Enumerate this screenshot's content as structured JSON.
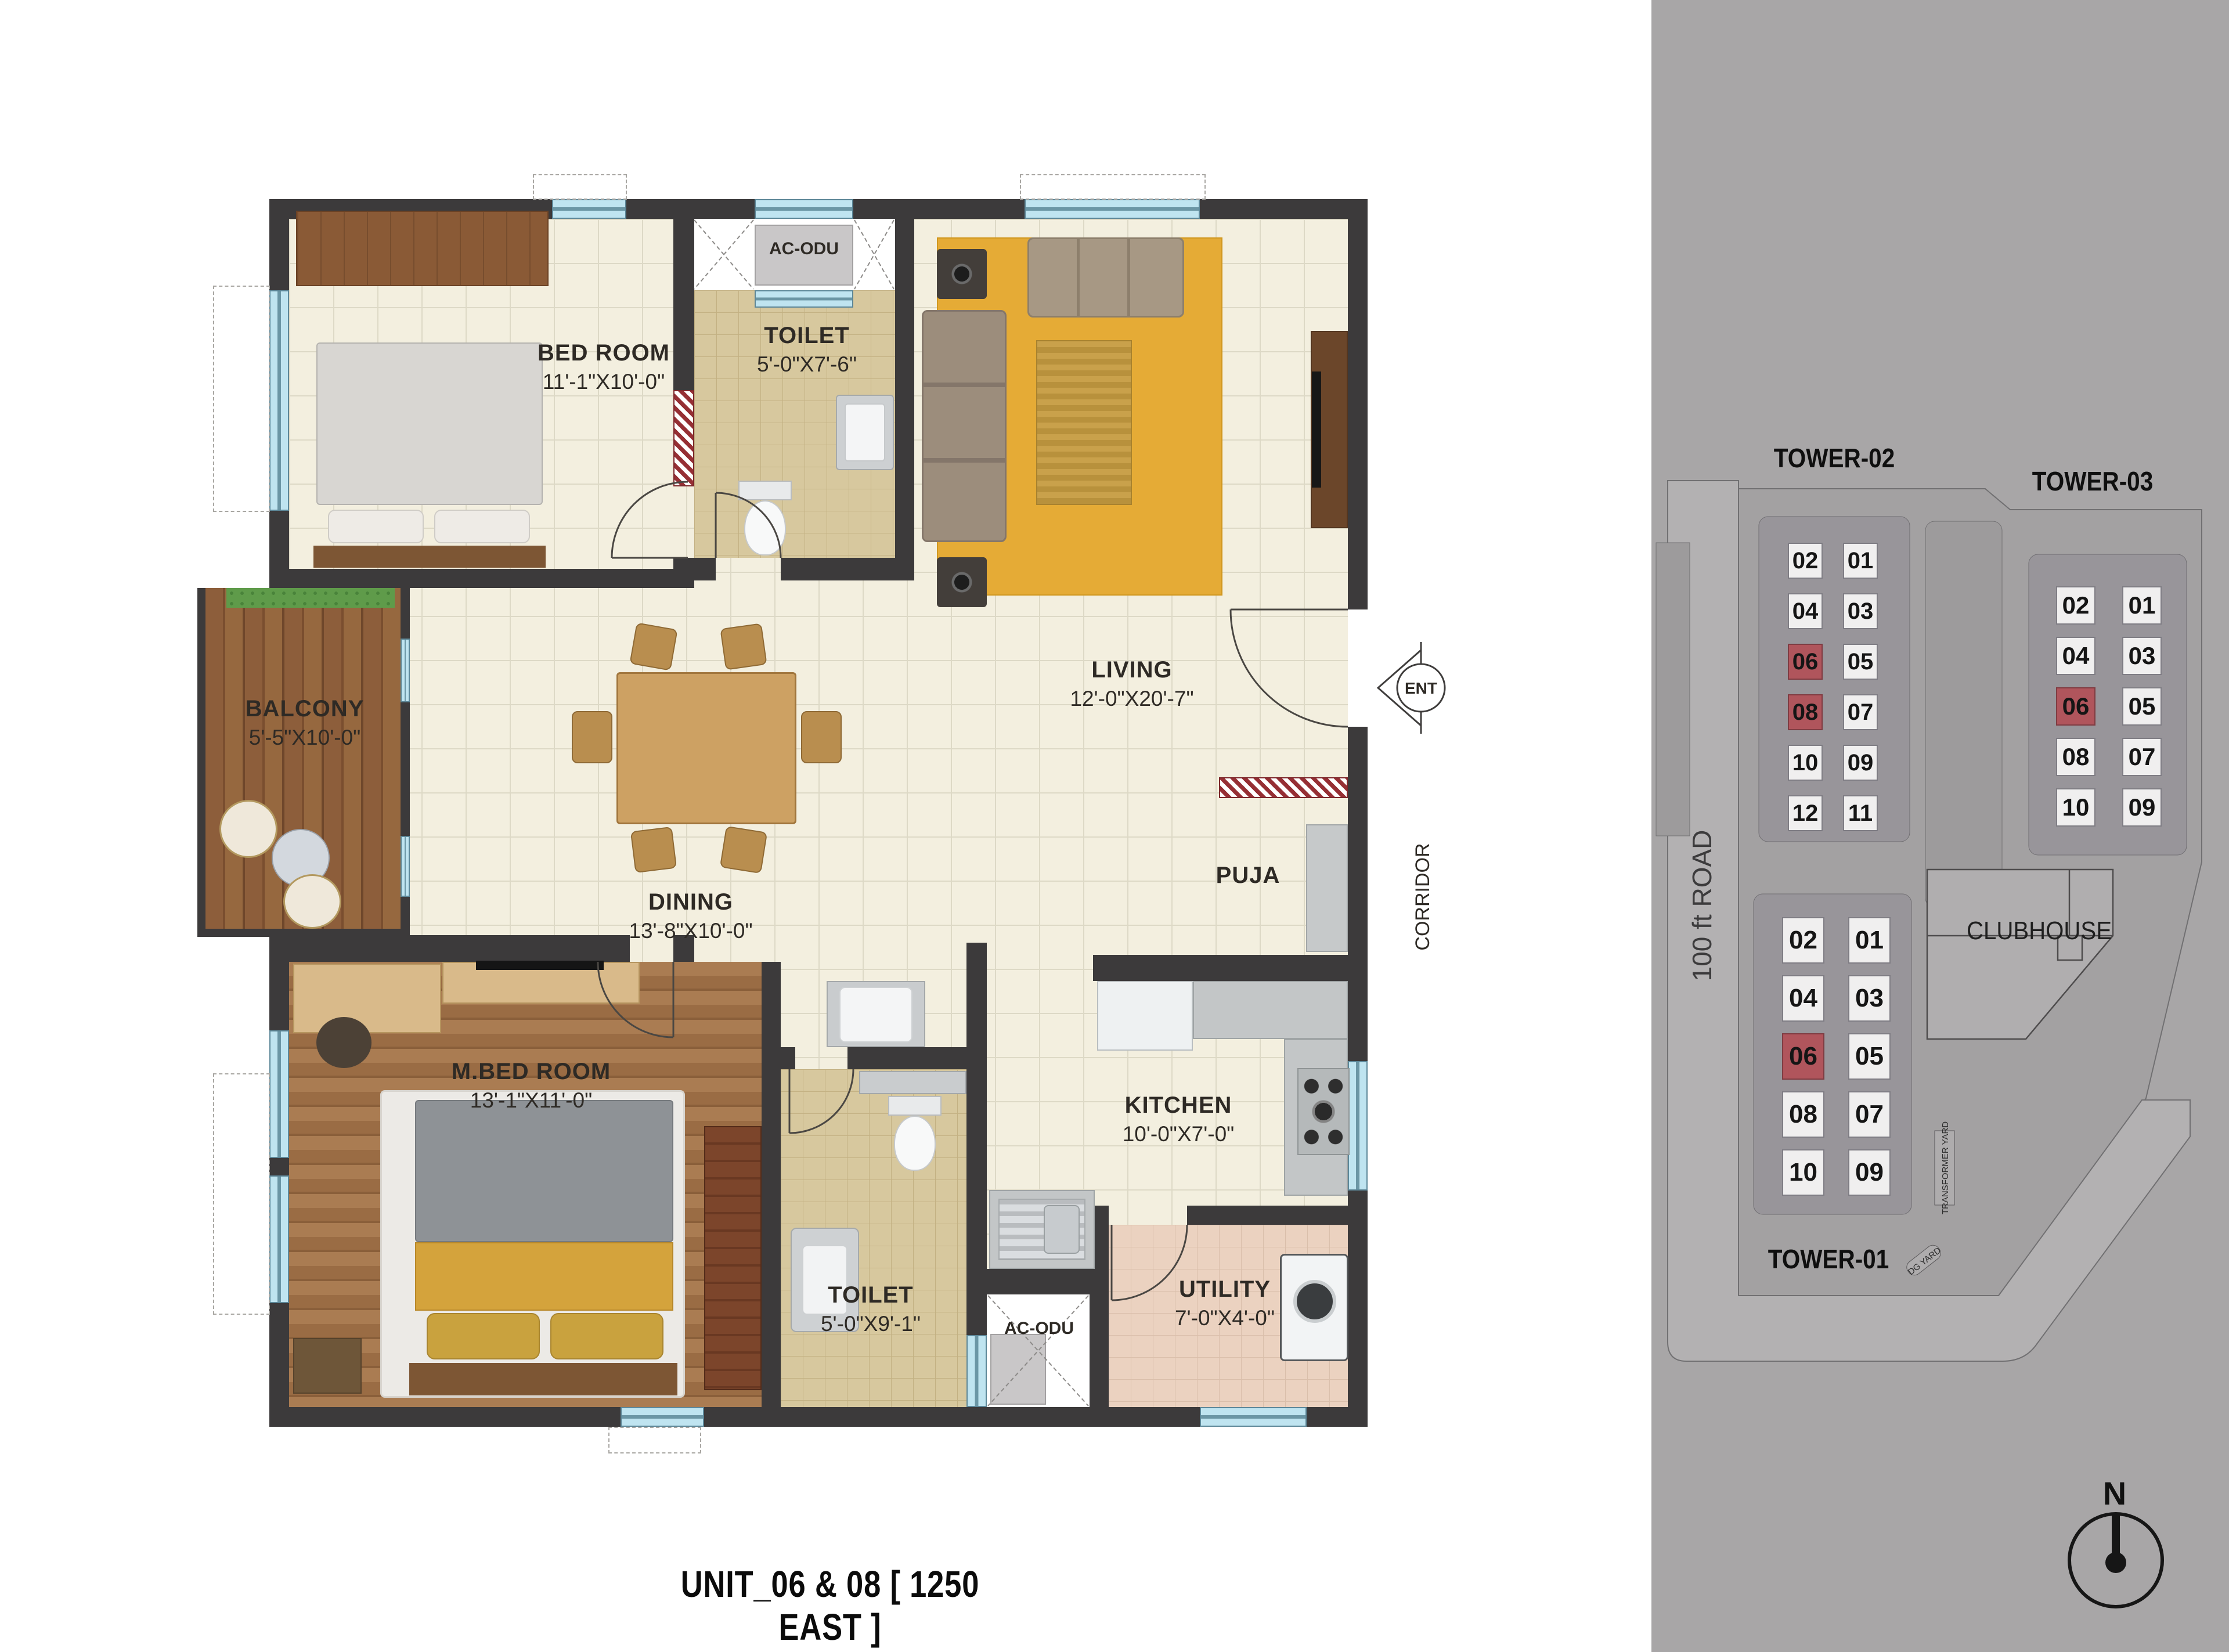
{
  "title": "UNIT_06 & 08 [ 1250 EAST ]",
  "plan": {
    "rooms": {
      "bedroom": {
        "name": "BED ROOM",
        "dims": "11'-1\"X10'-0\""
      },
      "toilet_top": {
        "name": "TOILET",
        "dims": "5'-0\"X7'-6\""
      },
      "living": {
        "name": "LIVING",
        "dims": "12'-0\"X20'-7\""
      },
      "balcony": {
        "name": "BALCONY",
        "dims": "5'-5\"X10'-0\""
      },
      "dining": {
        "name": "DINING",
        "dims": "13'-8\"X10'-0\""
      },
      "mbed": {
        "name": "M.BED ROOM",
        "dims": "13'-1\"X11'-0\""
      },
      "toilet_bottom": {
        "name": "TOILET",
        "dims": "5'-0\"X9'-1\""
      },
      "kitchen": {
        "name": "KITCHEN",
        "dims": "10'-0\"X7'-0\""
      },
      "utility": {
        "name": "UTILITY",
        "dims": "7'-0\"X4'-0\""
      },
      "puja": {
        "name": "PUJA"
      },
      "ac_top": {
        "name": "AC-ODU"
      },
      "ac_bottom": {
        "name": "AC-ODU"
      }
    },
    "markers": {
      "entrance": "ENT",
      "corridor": "CORRIDOR"
    }
  },
  "site": {
    "labels": {
      "road": "100 ft ROAD",
      "clubhouse": "CLUBHOUSE",
      "transformer_yard": "TRANSFORMER YARD",
      "dg_yard": "DG YARD",
      "north": "N"
    },
    "towers": [
      {
        "id": "tower-02",
        "name": "TOWER-02",
        "rows": [
          [
            "02",
            "01"
          ],
          [
            "04",
            "03"
          ],
          [
            "06",
            "05"
          ],
          [
            "08",
            "07"
          ],
          [
            "10",
            "09"
          ],
          [
            "12",
            "11"
          ]
        ],
        "highlighted": [
          "06",
          "08"
        ]
      },
      {
        "id": "tower-03",
        "name": "TOWER-03",
        "rows": [
          [
            "02",
            "01"
          ],
          [
            "04",
            "03"
          ],
          [
            "06",
            "05"
          ],
          [
            "08",
            "07"
          ],
          [
            "10",
            "09"
          ]
        ],
        "highlighted": [
          "06"
        ]
      },
      {
        "id": "tower-01",
        "name": "TOWER-01",
        "rows": [
          [
            "02",
            "01"
          ],
          [
            "04",
            "03"
          ],
          [
            "06",
            "05"
          ],
          [
            "08",
            "07"
          ],
          [
            "10",
            "09"
          ]
        ],
        "highlighted": [
          "06"
        ]
      }
    ],
    "colors": {
      "highlight": "#b0555c",
      "unit_cell": "#f0efef",
      "panel": "#a8a6a7",
      "wall": "#3c3a3b",
      "window": "#bfe4f0"
    }
  }
}
